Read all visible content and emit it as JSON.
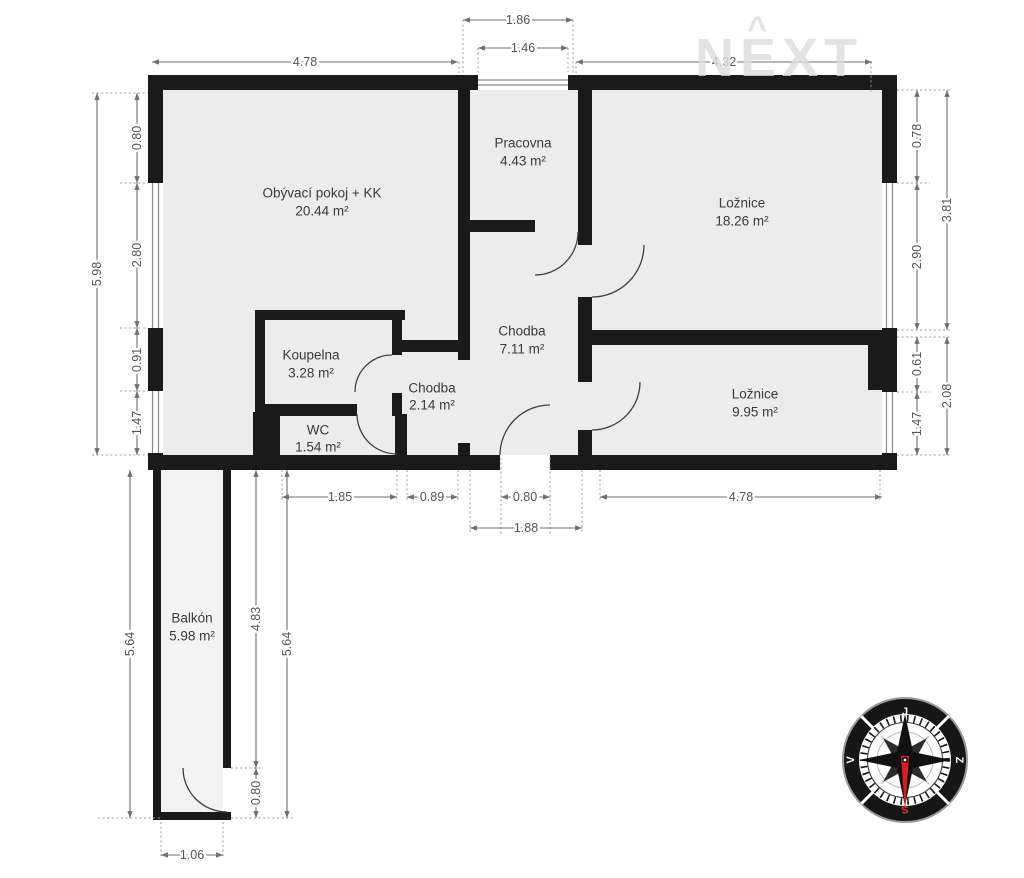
{
  "watermark": {
    "text": "NEXT",
    "caret": "^"
  },
  "rooms": {
    "living": {
      "name": "Obývací pokoj + KK",
      "area": "20.44 m²"
    },
    "study": {
      "name": "Pracovna",
      "area": "4.43 m²"
    },
    "bedroom1": {
      "name": "Ložnice",
      "area": "18.26 m²"
    },
    "hall": {
      "name": "Chodba",
      "area": "7.11 m²"
    },
    "bathroom": {
      "name": "Koupelna",
      "area": "3.28 m²"
    },
    "hall2": {
      "name": "Chodba",
      "area": "2.14 m²"
    },
    "wc": {
      "name": "WC",
      "area": "1.54 m²"
    },
    "bedroom2": {
      "name": "Ložnice",
      "area": "9.95 m²"
    },
    "balcony": {
      "name": "Balkón",
      "area": "5.98 m²"
    }
  },
  "dims": {
    "top_window_outer": "1.86",
    "top_window_inner": "1.46",
    "top_left": "4.78",
    "top_right": "4.32",
    "left_total": "5.98",
    "left_seg1": "0.80",
    "left_seg2": "2.80",
    "left_seg3": "0.91",
    "left_seg4": "1.47",
    "right_seg1": "0.78",
    "right_seg2": "2.90",
    "right_upper_total": "3.81",
    "right_seg3": "0.61",
    "right_seg4": "1.47",
    "right_lower_total": "2.08",
    "bottom_wc": "1.85",
    "bottom_hall": "0.89",
    "bottom_entry_door": "0.80",
    "bottom_entry": "1.88",
    "bottom_bedroom": "4.78",
    "balcony_left": "5.64",
    "balcony_wall": "4.83",
    "balcony_door": "0.80",
    "balcony_right": "5.64",
    "balcony_width": "1.06"
  },
  "compass": {
    "south": "J",
    "west": "Z",
    "north": "S",
    "east": "V"
  },
  "colors": {
    "wall": "#1a1a1a",
    "room_fill": "#ececec",
    "dimension": "#6f6f6f",
    "watermark": "#dedede",
    "compass_needle": "#d61f1f"
  }
}
